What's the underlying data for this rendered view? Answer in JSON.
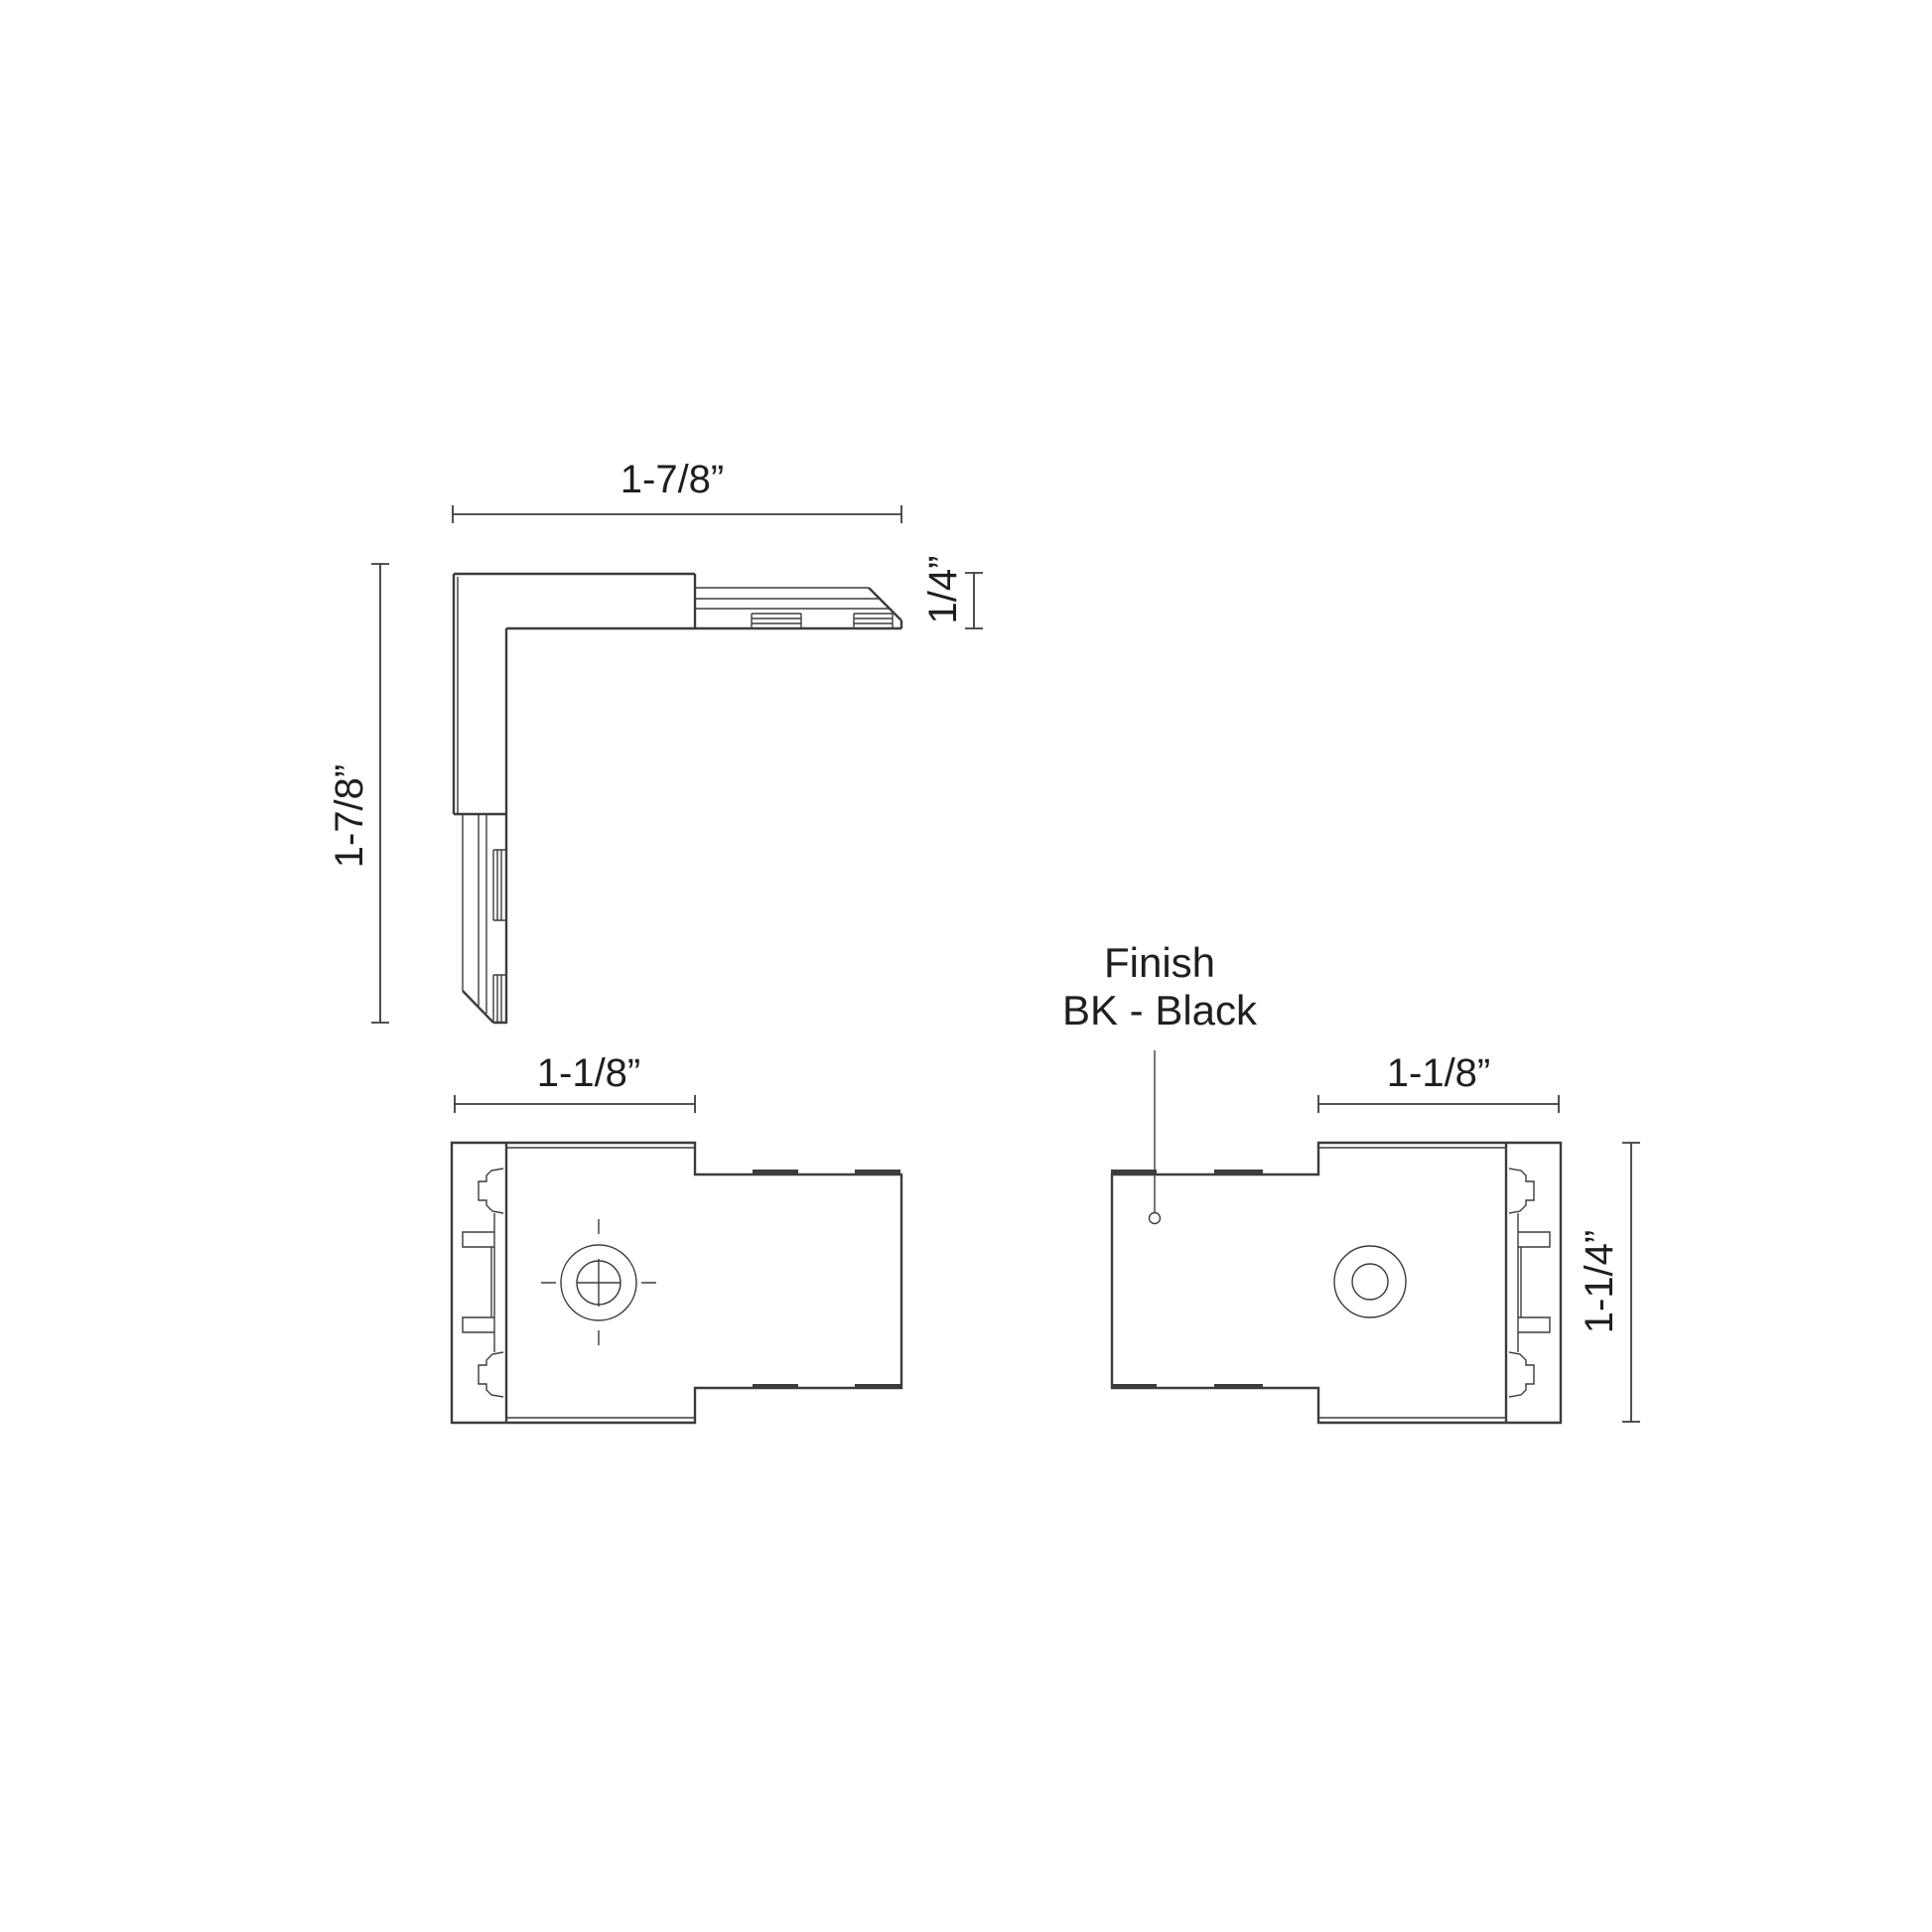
{
  "drawing": {
    "background": "#ffffff",
    "line_color": "#3c3c3c",
    "text_color": "#1f1f1f"
  },
  "top_view": {
    "width_label": "1-7/8”",
    "height_label": "1-7/8”",
    "thickness_label": "1/4”"
  },
  "front_view": {
    "width_label": "1-1/8”"
  },
  "back_view": {
    "width_label": "1-1/8”",
    "height_label": "1-1/4”"
  },
  "finish_note": {
    "title": "Finish",
    "value": "BK - Black"
  }
}
